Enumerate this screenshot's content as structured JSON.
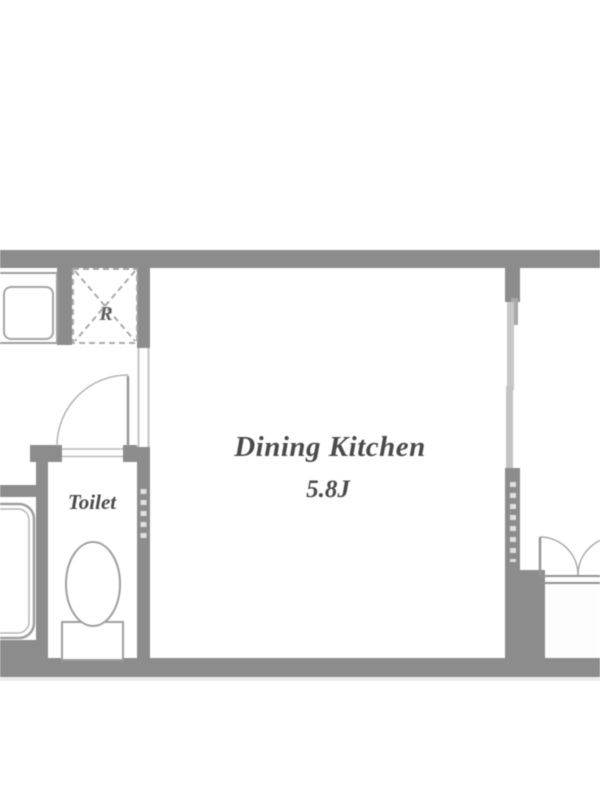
{
  "meta": {
    "type": "apartment-floorplan",
    "background": "#ffffff"
  },
  "colors": {
    "wall": "#8c8c8c",
    "wall_dark": "#7f7f7f",
    "fixture_line": "#9e9e9e",
    "light_line": "#c5c5c5",
    "dash_line": "#e0e0e0",
    "text": "#4a4a4a",
    "floor": "#ffffff"
  },
  "rooms": {
    "dining_kitchen": {
      "label": "Dining Kitchen",
      "size": "5.8J"
    },
    "toilet": {
      "label": "Toilet"
    },
    "refrigerator_space": {
      "label": "R"
    }
  },
  "fixtures": [
    "washing-machine-pan",
    "refrigerator-space",
    "toilet-bowl",
    "bathtub",
    "swing-door",
    "sliding-door",
    "closet-double-doors"
  ]
}
